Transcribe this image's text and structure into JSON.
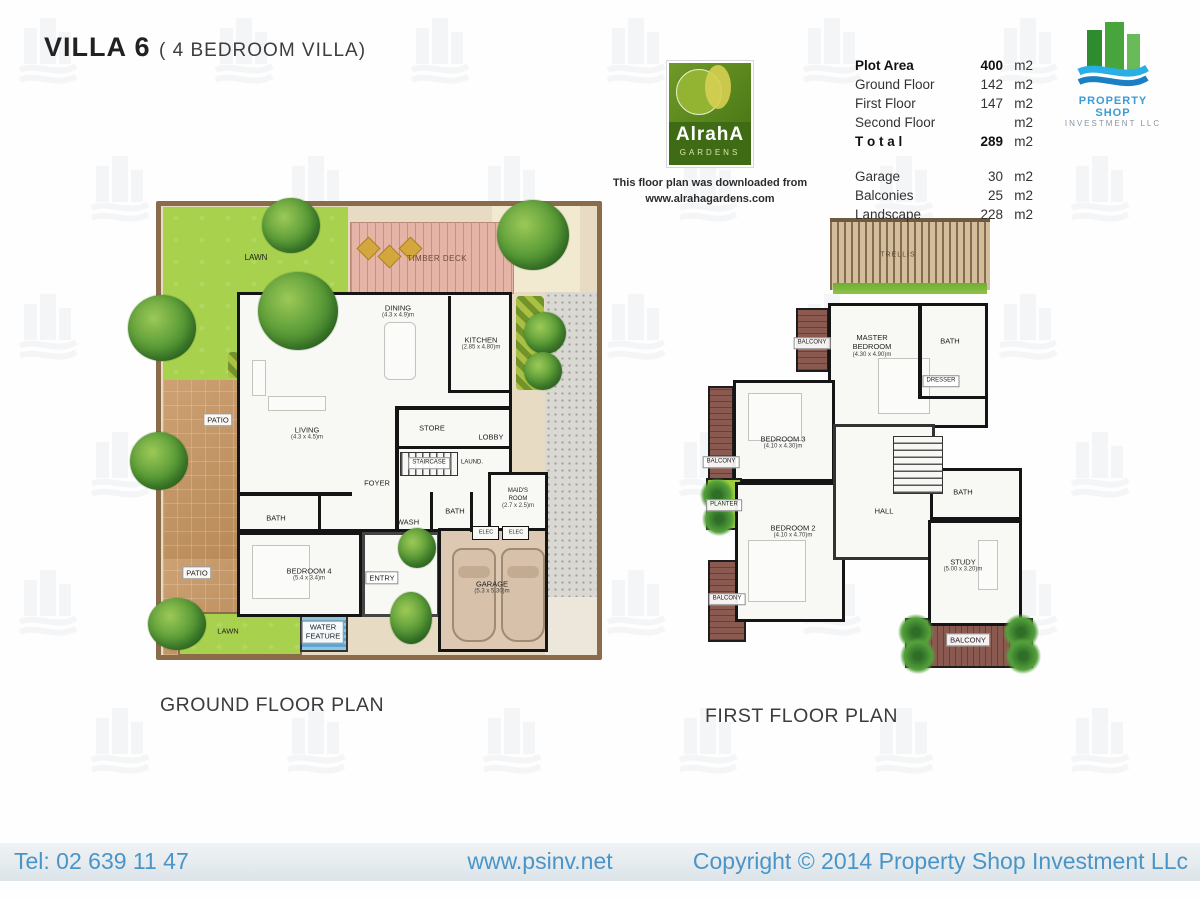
{
  "header": {
    "title": "VILLA 6",
    "subtitle": "( 4 BEDROOM VILLA)"
  },
  "alraha": {
    "logo_text": "AlrahA",
    "logo_sub": "GARDENS",
    "caption1": "This floor plan was downloaded from",
    "caption2": "www.alrahagardens.com"
  },
  "psi": {
    "name": "PROPERTY SHOP",
    "sub": "INVESTMENT LLC"
  },
  "areas": {
    "rows": [
      {
        "label": "Plot Area",
        "value": "400",
        "unit": "m2"
      },
      {
        "label": "Ground Floor",
        "value": "142",
        "unit": "m2"
      },
      {
        "label": "First Floor",
        "value": "147",
        "unit": "m2"
      },
      {
        "label": "Second Floor",
        "value": "",
        "unit": "m2"
      },
      {
        "label": "T o t a l",
        "value": "289",
        "unit": "m2"
      }
    ],
    "rows2": [
      {
        "label": "Garage",
        "value": "30",
        "unit": "m2"
      },
      {
        "label": "Balconies",
        "value": "25",
        "unit": "m2"
      },
      {
        "label": "Landscape",
        "value": "228",
        "unit": "m2"
      }
    ]
  },
  "ground": {
    "caption": "GROUND FLOOR PLAN",
    "labels": {
      "lawn_top": "LAWN",
      "timber_deck": "TIMBER DECK",
      "dining": "DINING",
      "dining_dim": "(4.3 x 4.9)m",
      "kitchen": "KITCHEN",
      "kitchen_dim": "(2.85 x 4.80)m",
      "living": "LIVING",
      "living_dim": "(4.3 x 4.5)m",
      "store": "STORE",
      "lobby": "LOBBY",
      "staircase": "STAIRCASE",
      "laundry": "LAUND.",
      "foyer": "FOYER",
      "wash": "WASH",
      "bath1": "BATH",
      "bath2": "BATH",
      "maids1": "MAID'S",
      "maids2": "ROOM",
      "maids_dim": "(2.7 x 2.5)m",
      "bedroom4": "BEDROOM 4",
      "bedroom4_dim": "(5.4 x 3.4)m",
      "entry": "ENTRY",
      "elec1": "ELEC",
      "elec2": "ELEC",
      "garage": "GARAGE",
      "garage_dim": "(5.3 x 5.30)m",
      "patio1": "PATIO",
      "patio2": "PATIO",
      "lawn_bottom": "LAWN",
      "water1": "WATER",
      "water2": "FEATURE"
    }
  },
  "first": {
    "caption": "FIRST FLOOR PLAN",
    "labels": {
      "trellis": "TRELLIS",
      "balcony_master": "BALCONY",
      "master1": "MASTER",
      "master2": "BEDROOM",
      "master_dim": "(4.30 x 4.90)m",
      "bath_top": "BATH",
      "dresser": "DRESSER",
      "bedroom3": "BEDROOM 3",
      "bedroom3_dim": "(4.10 x 4.30)m",
      "balcony3": "BALCONY",
      "planter": "PLANTER",
      "bedroom2": "BEDROOM 2",
      "bedroom2_dim": "(4.10 x 4.70)m",
      "balcony2": "BALCONY",
      "hall": "HALL",
      "bath_right": "BATH",
      "study": "STUDY",
      "study_dim": "(5.00 x 3.20)m",
      "balcony_bottom": "BALCONY"
    }
  },
  "footer": {
    "tel": "Tel: 02 639 11 47",
    "website": "www.psinv.net",
    "copyright": "Copyright © 2014 Property Shop Investment LLc"
  }
}
